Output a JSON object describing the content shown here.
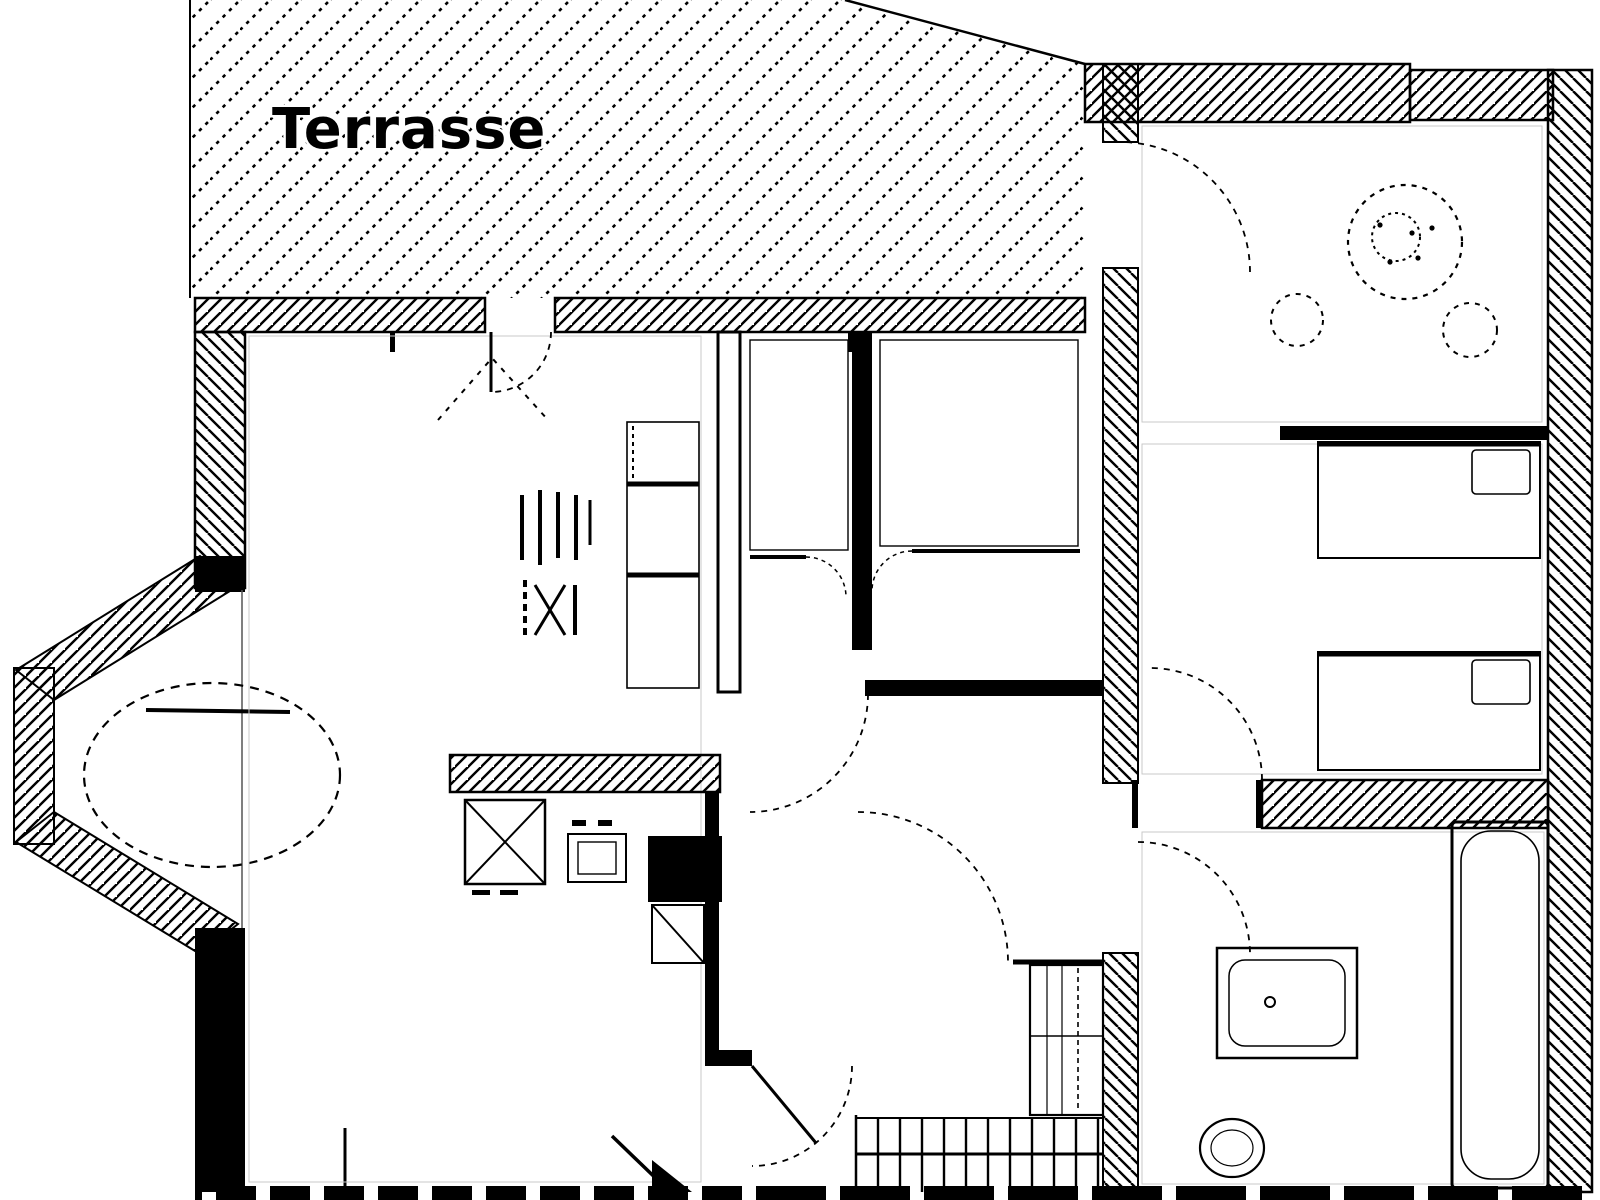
{
  "plan": {
    "terrace_label": "Terrasse"
  },
  "colors": {
    "ink": "#000000",
    "paper": "#ffffff",
    "faint_line": "#c9c9c9"
  }
}
